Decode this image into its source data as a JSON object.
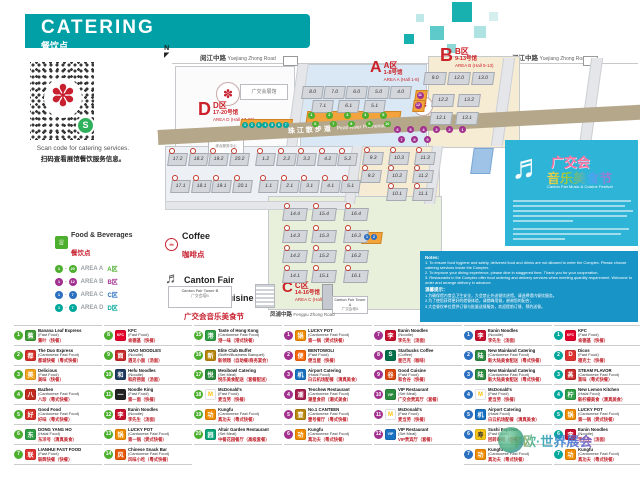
{
  "header": {
    "title": "CATERING",
    "subtitle": "餐饮点"
  },
  "qr": {
    "caption_en": "Scan code for catering services.",
    "caption_cn": "扫码查看展馆餐饮服务信息。",
    "flower_icon": "✽",
    "badge_icon": "S"
  },
  "colors": {
    "teal": "#00a0a6",
    "red": "#cc2229",
    "area_a": "#4caf2e",
    "area_b": "#a2308f",
    "area_c": "#2a6fc0",
    "area_d": "#00a79b"
  },
  "legend": {
    "food_title": "Food & Beverages",
    "food_title_cn": "餐饮点",
    "rows": [
      {
        "from": "1",
        "to": "20",
        "label": "AREA A",
        "cn": "A区",
        "color": "#4caf2e"
      },
      {
        "from": "1",
        "to": "12",
        "label": "AREA B",
        "cn": "B区",
        "color": "#a2308f"
      },
      {
        "from": "1",
        "to": "7",
        "label": "AREA C",
        "cn": "C区",
        "color": "#2a6fc0"
      },
      {
        "from": "1",
        "to": "7",
        "label": "AREA D",
        "cn": "D区",
        "color": "#00a79b"
      }
    ],
    "coffee": {
      "label": "Coffee",
      "cn": "咖啡点"
    },
    "festival": {
      "line1": "Canton Fair",
      "line2": "Music & Cuisine Festival",
      "cn": "广交会音乐美食节"
    }
  },
  "map": {
    "north": "N",
    "roads": {
      "top_left_cn": "阅江中路",
      "top_left_en": "Yuejiang Zhong Road",
      "top_right_cn": "阅江中路",
      "top_right_en": "Yuejiang Zhong Road",
      "promenade_cn": "珠江散步道",
      "promenade_en": "Pearl River Promenade",
      "bottom_cn": "凤浦中路",
      "bottom_en": "Fengpu Zhong Road"
    },
    "areas": [
      {
        "id": "A",
        "letter": "A",
        "cn": "A区",
        "halls": "1-8号馆",
        "en": "AREA A (Hall 1-8)"
      },
      {
        "id": "B",
        "letter": "B",
        "cn": "B区",
        "halls": "9-13号馆",
        "en": "AREA B (Hall 9-13)"
      },
      {
        "id": "C",
        "letter": "C",
        "cn": "C区",
        "halls": "14-16号馆",
        "en": "AREA C (Hall 14-16)"
      },
      {
        "id": "D",
        "letter": "D",
        "cn": "D区",
        "halls": "17-20号馆",
        "en": "AREA D (Hall 17-20)"
      }
    ],
    "buildings": {
      "expo": "广交会展馆",
      "service_center_en": "Comprehensive Service Center",
      "service_center_cn": "综合服务中心",
      "tower_b_en": "Canton Fair Tower B",
      "tower_b_cn": "广交会塔B",
      "tower_a_en": "Canton Fair Tower A",
      "tower_a_cn": "广交会塔A"
    },
    "halls": {
      "a_top": [
        "8.0",
        "7.0",
        "6.0",
        "5.0",
        "4.0"
      ],
      "a_mid": [
        "7.1",
        "6.1",
        "5.1"
      ],
      "b_top": [
        "9.0",
        "12.0",
        "13.0"
      ],
      "b_mid": [
        "12.2",
        "13.2"
      ],
      "b_low": [
        "12.1",
        "13.1"
      ],
      "sw_row1": [
        "17.2",
        "18.2",
        "19.2",
        "20.2",
        "1.2",
        "2.2",
        "3.2",
        "4.2",
        "5.2"
      ],
      "sw_row2": [
        "17.1",
        "18.1",
        "19.1",
        "20.1",
        "1.1",
        "2.1",
        "3.1",
        "4.1",
        "5.1"
      ],
      "bs_row1": [
        "9.3",
        "10.3",
        "11.3"
      ],
      "bs_row2": [
        "9.2",
        "10.2",
        "11.2"
      ],
      "bs_row3": [
        "10.1",
        "11.1"
      ],
      "c_rows": [
        [
          "14.4",
          "15.4",
          "16.4"
        ],
        [
          "14.3",
          "15.3",
          "16.3"
        ],
        [
          "14.2",
          "15.2",
          "16.2"
        ],
        [
          "14.1",
          "15.1",
          "16.1"
        ]
      ]
    },
    "markers": {
      "a": [
        "1",
        "2",
        "3",
        "4",
        "5",
        "6",
        "7",
        "8",
        "9",
        "10"
      ],
      "b_row1": [
        "6",
        "5",
        "4",
        "3",
        "2",
        "1"
      ],
      "b_row2": [
        "7",
        "8",
        "9"
      ],
      "b_mini": [
        "11",
        "12"
      ],
      "c": [
        "1",
        "2"
      ],
      "d": [
        "1",
        "2",
        "3",
        "4",
        "5",
        "6",
        "7"
      ]
    }
  },
  "festival_banner": {
    "title_1": "广交会",
    "title_2": "音乐美食节",
    "subtitle": "Canton Fair Music & Cuisine Festival",
    "clef_icon": "♬"
  },
  "notes": {
    "title_en": "Notes:",
    "items_en": [
      "To ensure food hygiene and safety, delivered food and drinks are not allowed to enter the Complex. Please choose catering services inside the Complex.",
      "To improve your dining experience, please dine in staggered time. Thank you for your cooperation.",
      "Restaurants in the Complex offer food ordering and delivery services when meeting quantity requirement. Welcome to order and arrange delivery in advance."
    ],
    "title_cn": "温馨提示：",
    "items_cn": [
      "为确保馆内食品卫生安全，大会禁止外送餐饮进馆，请选择馆内餐饮服务。",
      "为了使您获得更好的就餐体验，请错峰用餐，谢谢您的配合；",
      "大会餐饮单位提供订餐与批量送餐服务，欢迎提前订餐、预约送餐。"
    ]
  },
  "directory": {
    "columns": [
      {
        "area": "A",
        "color": "#4caf2e",
        "entries": [
          {
            "num": "1",
            "name": "Banana Leaf Express",
            "category": "(Fast Food)",
            "cn": "蕉叶（快餐）",
            "logo": {
              "text": "蕉",
              "bg": "#3f9c35",
              "fg": "#fff"
            }
          },
          {
            "num": "2",
            "name": "The Duo Express",
            "category": "(Cantonese Fast Food)",
            "cn": "都城快餐（粤式快餐）",
            "logo": {
              "text": "都",
              "bg": "#d42e26",
              "fg": "#fff"
            }
          },
          {
            "num": "3",
            "name": "Delicious",
            "category": "(Fast Food)",
            "cn": "美味（快餐）",
            "logo": {
              "text": "美",
              "bg": "#f2a41f",
              "fg": "#fff"
            }
          },
          {
            "num": "4",
            "name": "Bazhen",
            "category": "(Cantonese Fast Food)",
            "cn": "八珍（粤式快餐）",
            "logo": {
              "text": "八",
              "bg": "#c22a20",
              "fg": "#fff"
            }
          },
          {
            "num": "5",
            "name": "Good Food",
            "category": "(Cantonese Fast Food)",
            "cn": "好味（粤式快餐）",
            "logo": {
              "text": "好",
              "bg": "#d42e26",
              "fg": "#fff"
            }
          },
          {
            "num": "6",
            "name": "DONG YANG HO",
            "category": "(Halal Food)",
            "cn": "东洋号（清真美食）",
            "logo": {
              "text": "东",
              "bg": "#2f9e44",
              "fg": "#fff"
            }
          },
          {
            "num": "7",
            "name": "LIANHUI FAST FOOD",
            "category": "(Fast Food)",
            "cn": "联辉快餐（快餐）",
            "logo": {
              "text": "联",
              "bg": "#e03131",
              "fg": "#fff"
            }
          }
        ]
      },
      {
        "area": "A",
        "color": "#4caf2e",
        "entries": [
          {
            "num": "8",
            "name": "KFC",
            "category": "(Fast Food)",
            "cn": "肯德基（快餐）",
            "logo": {
              "text": "KFC",
              "bg": "#e4002b",
              "fg": "#fff"
            }
          },
          {
            "num": "9",
            "name": "XIAO NOODLES",
            "category": "(Noodle)",
            "cn": "遇见小面（汤面）",
            "logo": {
              "text": "面",
              "bg": "#c92a2a",
              "fg": "#fff"
            }
          },
          {
            "num": "10",
            "name": "Hefu Noodles",
            "category": "(Noodle)",
            "cn": "和府捞面（汤面）",
            "logo": {
              "text": "和",
              "bg": "#1e3a5f",
              "fg": "#fff"
            }
          },
          {
            "num": "11",
            "name": "Noodle King",
            "category": "(Fast Food)",
            "cn": "第一面（快餐）",
            "logo": {
              "text": "一",
              "bg": "#222222",
              "fg": "#fff"
            }
          },
          {
            "num": "12",
            "name": "Eanin Noodles",
            "category": "(Noodle)",
            "cn": "李先生（汤面）",
            "logo": {
              "text": "李",
              "bg": "#c8102e",
              "fg": "#fff"
            }
          },
          {
            "num": "13",
            "name": "LUCKY POT",
            "category": "(Cantonese Fast Food)",
            "cn": "第一锅（煲式快餐）",
            "logo": {
              "text": "锅",
              "bg": "#f08c00",
              "fg": "#fff"
            }
          },
          {
            "num": "14",
            "name": "Chinese Snack Bar",
            "category": "(Cantonese Fast Food)",
            "cn": "风味小吃（粤式快餐）",
            "logo": {
              "text": "风",
              "bg": "#e8590c",
              "fg": "#fff"
            }
          }
        ]
      },
      {
        "area": "A",
        "color": "#4caf2e",
        "entries": [
          {
            "num": "15",
            "name": "Taste of Hong Kong",
            "category": "(Cantonese Fast Food)",
            "cn": "港一味（港式快餐）",
            "logo": {
              "text": "港",
              "bg": "#2f9e44",
              "fg": "#fff"
            }
          },
          {
            "num": "16",
            "name": "Elite Club Buffet",
            "category": "(Buffet/Business Banquet)",
            "cn": "新领翔（自助餐/商务宴会）",
            "logo": {
              "text": "新",
              "bg": "#b8860b",
              "fg": "#fff"
            }
          },
          {
            "num": "17",
            "name": "Mexibowl Catering",
            "category": "(Set Meal)",
            "cn": "悦乐美食配送（套餐配送）",
            "logo": {
              "text": "悦",
              "bg": "#2b8a3e",
              "fg": "#fff"
            }
          },
          {
            "num": "18",
            "name": "McDonald's",
            "category": "(Fast Food)",
            "cn": "麦当劳（快餐）",
            "logo": {
              "text": "M",
              "bg": "#ffffff",
              "fg": "#ffc40c"
            }
          },
          {
            "num": "19",
            "name": "Kungfu",
            "category": "(Cantonese Fast Food)",
            "cn": "真功夫（粤式快餐）",
            "logo": {
              "text": "功",
              "bg": "#f08c00",
              "fg": "#fff"
            }
          },
          {
            "num": "20",
            "name": "Altair Garden Restaurant",
            "category": "(Set Meal)",
            "cn": "中餐花园餐厅（高级套餐）",
            "logo": {
              "text": "园",
              "bg": "#0ca678",
              "fg": "#fff"
            }
          }
        ]
      },
      {
        "area": "B",
        "color": "#a2308f",
        "entries": [
          {
            "num": "1",
            "name": "LUCKY POT",
            "category": "(Cantonese Fast Food)",
            "cn": "第一锅（煲式快餐）",
            "logo": {
              "text": "锅",
              "bg": "#f08c00",
              "fg": "#fff"
            }
          },
          {
            "num": "2",
            "name": "BENTOWOLI",
            "category": "(Fast Food)",
            "cn": "便当屋（快餐）",
            "logo": {
              "text": "便",
              "bg": "#f76707",
              "fg": "#fff"
            }
          },
          {
            "num": "3",
            "name": "Airport Catering",
            "category": "(Halal Food)",
            "cn": "白云机场配餐（清真美食）",
            "logo": {
              "text": "机",
              "bg": "#1971c2",
              "fg": "#fff"
            }
          },
          {
            "num": "4",
            "name": "Teochew Restaurant",
            "category": "(Cantonese Fast Food)",
            "cn": "潮皇食府（潮式美食）",
            "logo": {
              "text": "潮",
              "bg": "#a61e4d",
              "fg": "#fff"
            }
          },
          {
            "num": "5",
            "name": "No.1 CANTEEN",
            "category": "(Cantonese Fast Food)",
            "cn": "壹号餐厅（粤式快餐）",
            "logo": {
              "text": "壹",
              "bg": "#b8860b",
              "fg": "#fff"
            }
          },
          {
            "num": "6",
            "name": "Kungfu",
            "category": "(Cantonese Fast Food)",
            "cn": "真功夫（粤式快餐）",
            "logo": {
              "text": "功",
              "bg": "#f08c00",
              "fg": "#fff"
            }
          }
        ]
      },
      {
        "area": "B",
        "color": "#a2308f",
        "entries": [
          {
            "num": "7",
            "name": "Eanin Noodles",
            "category": "(Noodle)",
            "cn": "李先生（汤面）",
            "logo": {
              "text": "李",
              "bg": "#c8102e",
              "fg": "#fff"
            }
          },
          {
            "num": "8",
            "name": "Starbucks Coffee",
            "category": "(Coffee)",
            "cn": "星巴克（咖啡）",
            "logo": {
              "text": "S",
              "bg": "#00704a",
              "fg": "#fff"
            }
          },
          {
            "num": "9",
            "name": "Good Cuisine",
            "category": "(Fast Food)",
            "cn": "和合谷（快餐）",
            "logo": {
              "text": "谷",
              "bg": "#d9480f",
              "fg": "#fff"
            }
          },
          {
            "num": "10",
            "name": "VIP Restaurant",
            "category": "(Set Meal)",
            "cn": "广交会贵宾厅（套餐）",
            "logo": {
              "text": "VIP",
              "bg": "#2b8a3e",
              "fg": "#fff"
            }
          },
          {
            "num": "11",
            "name": "McDonald's",
            "category": "(Fast Food)",
            "cn": "麦当劳（快餐）",
            "logo": {
              "text": "M",
              "bg": "#ffffff",
              "fg": "#ffc40c"
            }
          },
          {
            "num": "12",
            "name": "VIP Restaurant",
            "category": "(Set Meal)",
            "cn": "VIP贵宾厅（套餐）",
            "logo": {
              "text": "VIP",
              "bg": "#1971c2",
              "fg": "#fff"
            }
          }
        ]
      },
      {
        "area": "C",
        "color": "#2a6fc0",
        "entries": [
          {
            "num": "1",
            "name": "Eanin Noodles",
            "category": "(Noodle)",
            "cn": "李先生（汤面）",
            "logo": {
              "text": "李",
              "bg": "#c8102e",
              "fg": "#fff"
            }
          },
          {
            "num": "2",
            "name": "New Mainland Catering",
            "category": "(Cantonese Fast Food)",
            "cn": "新大陆美食配送（粤式快餐）",
            "logo": {
              "text": "陆",
              "bg": "#2b8a3e",
              "fg": "#fff"
            }
          },
          {
            "num": "3",
            "name": "New Mainland Catering",
            "category": "(Cantonese Fast Food)",
            "cn": "新大陆美食配送（粤式快餐）",
            "logo": {
              "text": "陆",
              "bg": "#2b8a3e",
              "fg": "#fff"
            }
          },
          {
            "num": "4",
            "name": "McDonald's",
            "category": "(Fast Food)",
            "cn": "麦当劳（快餐）",
            "logo": {
              "text": "M",
              "bg": "#ffffff",
              "fg": "#ffc40c"
            }
          },
          {
            "num": "5",
            "name": "Airport Catering",
            "category": "(Halal Food)",
            "cn": "白云机场配餐（清真美食）",
            "logo": {
              "text": "机",
              "bg": "#1971c2",
              "fg": "#fff"
            }
          },
          {
            "num": "6",
            "name": "Sushi Express",
            "category": "(Fast Food)",
            "cn": "回转寿司（快餐）",
            "logo": {
              "text": "寿",
              "bg": "#f5c518",
              "fg": "#333"
            }
          },
          {
            "num": "7",
            "name": "Kungfu",
            "category": "(Cantonese Fast Food)",
            "cn": "真功夫（粤式快餐）",
            "logo": {
              "text": "功",
              "bg": "#f08c00",
              "fg": "#fff"
            }
          }
        ]
      },
      {
        "area": "D",
        "color": "#00a79b",
        "entries": [
          {
            "num": "1",
            "name": "KFC",
            "category": "(Fast Food)",
            "cn": "肯德基（快餐）",
            "logo": {
              "text": "KFC",
              "bg": "#e4002b",
              "fg": "#fff"
            }
          },
          {
            "num": "2",
            "name": "Dicos",
            "category": "(Fast Food)",
            "cn": "德克士（快餐）",
            "logo": {
              "text": "D",
              "bg": "#e03131",
              "fg": "#fff"
            }
          },
          {
            "num": "3",
            "name": "STEAM FLAVOR",
            "category": "(Cantonese Fast Food)",
            "cn": "蒸味（粤式快餐）",
            "logo": {
              "text": "蒸",
              "bg": "#c92a2a",
              "fg": "#fff"
            }
          },
          {
            "num": "4",
            "name": "New Lemon Kitchen",
            "category": "(Halal Food)",
            "cn": "新柠檬美食（清真美食）",
            "logo": {
              "text": "柠",
              "bg": "#2f9e44",
              "fg": "#fff"
            }
          },
          {
            "num": "5",
            "name": "LUCKY POT",
            "category": "(Cantonese Fast Food)",
            "cn": "第一锅（煲式快餐）",
            "logo": {
              "text": "锅",
              "bg": "#f08c00",
              "fg": "#fff"
            }
          },
          {
            "num": "6",
            "name": "Eanin Noodles",
            "category": "(Noodle)",
            "cn": "李先生（汤面）",
            "logo": {
              "text": "李",
              "bg": "#c8102e",
              "fg": "#fff"
            }
          },
          {
            "num": "7",
            "name": "Kungfu",
            "category": "(Cantonese Fast Food)",
            "cn": "真功夫（粤式快餐）",
            "logo": {
              "text": "功",
              "bg": "#f08c00",
              "fg": "#fff"
            }
          }
        ]
      }
    ]
  },
  "watermark": {
    "text": "中欧·世界展会"
  }
}
